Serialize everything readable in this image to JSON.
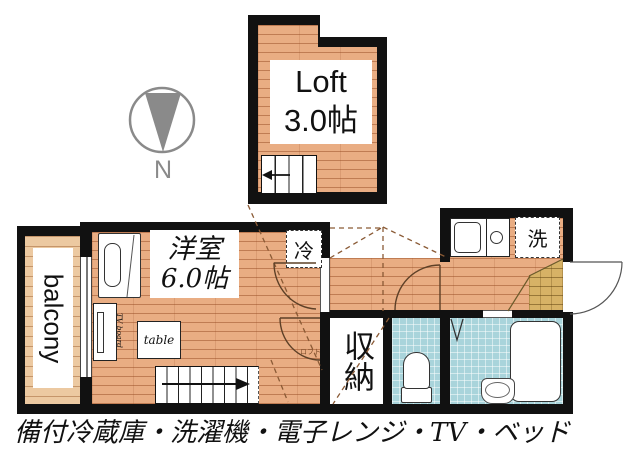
{
  "caption": "備付冷蔵庫・洗濯機・電子レンジ・TV・ベッド",
  "compass": {
    "label": "N"
  },
  "loft": {
    "label": "Loft",
    "size": "3.0帖"
  },
  "main_room": {
    "label": "洋室",
    "size": "6.0帖"
  },
  "balcony": {
    "label": "balcony"
  },
  "storage": {
    "label": "収納"
  },
  "refrigerator": {
    "label": "冷"
  },
  "washer": {
    "label": "洗"
  },
  "tv_board": {
    "label": "TV board"
  },
  "table": {
    "label": "table"
  },
  "loft_marker": {
    "label": "ロフト"
  },
  "colors": {
    "wall": "#111111",
    "wood": "#e9ad83",
    "wood_line": "#c08050",
    "balcony_wood": "#ecc9a1",
    "tile": "#a9d4db",
    "step_tan": "#d7b266",
    "compass_gray": "#8a8a8a",
    "dash_brown": "#8a5a35"
  }
}
